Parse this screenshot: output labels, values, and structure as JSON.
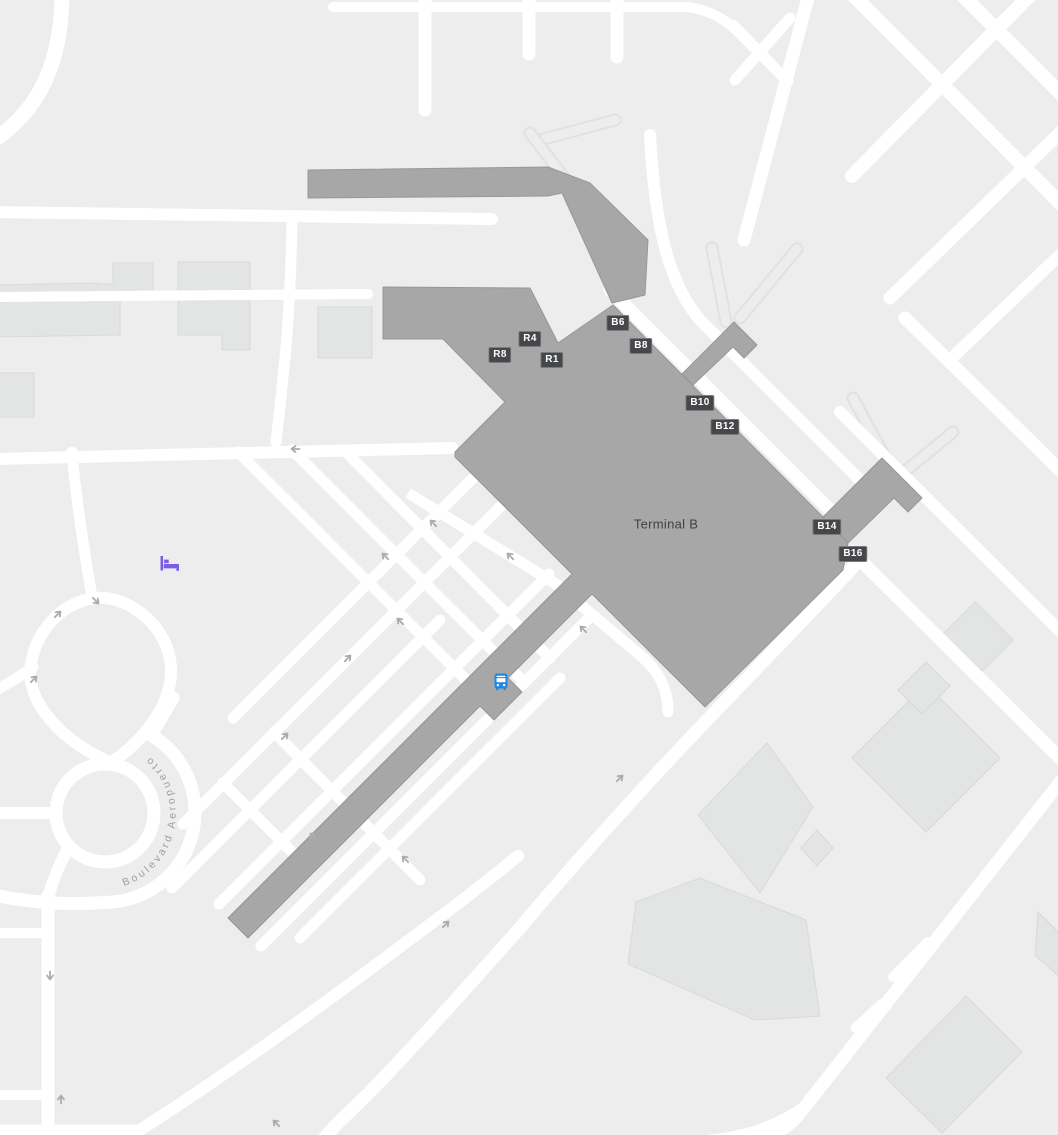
{
  "map": {
    "terminal": {
      "label": "Terminal B",
      "x": 666,
      "y": 524
    },
    "street": {
      "name": "Boulevard Aeropuerto"
    },
    "gates": [
      {
        "label": "R8",
        "x": 500,
        "y": 355
      },
      {
        "label": "R4",
        "x": 530,
        "y": 339
      },
      {
        "label": "R1",
        "x": 552,
        "y": 360
      },
      {
        "label": "B6",
        "x": 618,
        "y": 323
      },
      {
        "label": "B8",
        "x": 641,
        "y": 346
      },
      {
        "label": "B10",
        "x": 700,
        "y": 403
      },
      {
        "label": "B12",
        "x": 725,
        "y": 427
      },
      {
        "label": "B14",
        "x": 827,
        "y": 527
      },
      {
        "label": "B16",
        "x": 853,
        "y": 554
      }
    ],
    "pois": [
      {
        "name": "bus-station",
        "x": 501,
        "y": 684
      },
      {
        "name": "hotel",
        "x": 170,
        "y": 566
      }
    ],
    "colors": {
      "bg": "#ECEDEC",
      "road": "#FFFFFF",
      "building": "#E3E5E4",
      "building_line": "#D8DAD9",
      "terminal": "#A7A7A7",
      "terminal_line": "#979797",
      "badge_bg": "#45474A",
      "badge_text": "#FFFFFF",
      "terminal_text": "#3E4347",
      "street_text": "#9BA0A4",
      "arrow": "#AAADAF",
      "taxiway_line": "#E0E2E1",
      "bus": "#1E88E5",
      "hotel": "#7B5CE5"
    }
  }
}
